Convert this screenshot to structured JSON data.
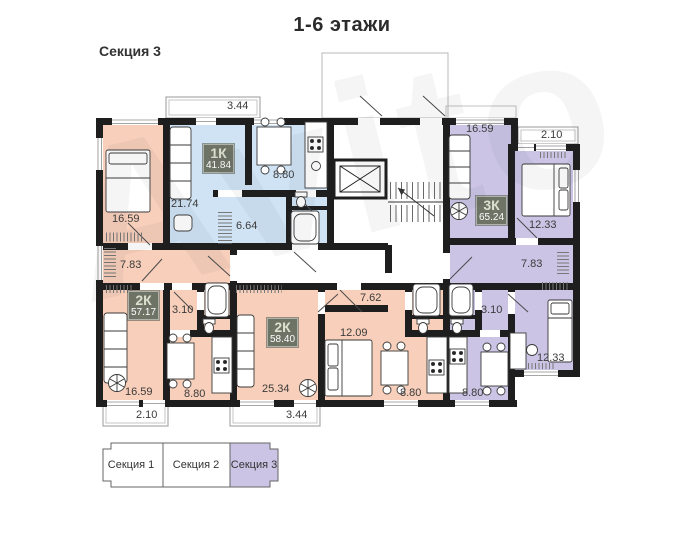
{
  "title": "1-6 этажи",
  "section_label": "Секция 3",
  "watermark": "Avito",
  "colors": {
    "wall": "#1e1e1e",
    "apartment_peach": "#f8cfba",
    "apartment_blue": "#cfe3f4",
    "apartment_purple": "#cbc4e5",
    "badge_background": "#6d7365",
    "legend_active_fill": "#cbc4e5"
  },
  "floorplan": {
    "apartments": [
      {
        "label": "1К",
        "area": "41.84",
        "x": 203,
        "y": 144
      },
      {
        "label": "2К",
        "area": "57.17",
        "x": 128,
        "y": 291
      },
      {
        "label": "2К",
        "area": "58.40",
        "x": 267,
        "y": 318
      },
      {
        "label": "3К",
        "area": "65.24",
        "x": 476,
        "y": 196
      }
    ],
    "dimensions": [
      {
        "text": "3.44",
        "x": 227,
        "y": 100
      },
      {
        "text": "16.59",
        "x": 112,
        "y": 213
      },
      {
        "text": "21.74",
        "x": 171,
        "y": 198
      },
      {
        "text": "8.80",
        "x": 273,
        "y": 169
      },
      {
        "text": "6.64",
        "x": 236,
        "y": 220
      },
      {
        "text": "7.83",
        "x": 120,
        "y": 259
      },
      {
        "text": "3.10",
        "x": 172,
        "y": 304
      },
      {
        "text": "16.59",
        "x": 125,
        "y": 386
      },
      {
        "text": "8.80",
        "x": 184,
        "y": 388
      },
      {
        "text": "2.10",
        "x": 136,
        "y": 409
      },
      {
        "text": "25.34",
        "x": 262,
        "y": 383
      },
      {
        "text": "3.44",
        "x": 286,
        "y": 409
      },
      {
        "text": "12.09",
        "x": 340,
        "y": 327
      },
      {
        "text": "7.62",
        "x": 360,
        "y": 292
      },
      {
        "text": "8.80",
        "x": 400,
        "y": 387
      },
      {
        "text": "8.80",
        "x": 462,
        "y": 387
      },
      {
        "text": "3.10",
        "x": 481,
        "y": 304
      },
      {
        "text": "12.33",
        "x": 537,
        "y": 352
      },
      {
        "text": "7.83",
        "x": 521,
        "y": 258
      },
      {
        "text": "16.59",
        "x": 466,
        "y": 123
      },
      {
        "text": "2.10",
        "x": 541,
        "y": 129
      },
      {
        "text": "12.33",
        "x": 529,
        "y": 219
      }
    ]
  },
  "legend": {
    "items": [
      {
        "label": "Секция 1",
        "active": false
      },
      {
        "label": "Секция 2",
        "active": false
      },
      {
        "label": "Секция 3",
        "active": true
      }
    ]
  }
}
